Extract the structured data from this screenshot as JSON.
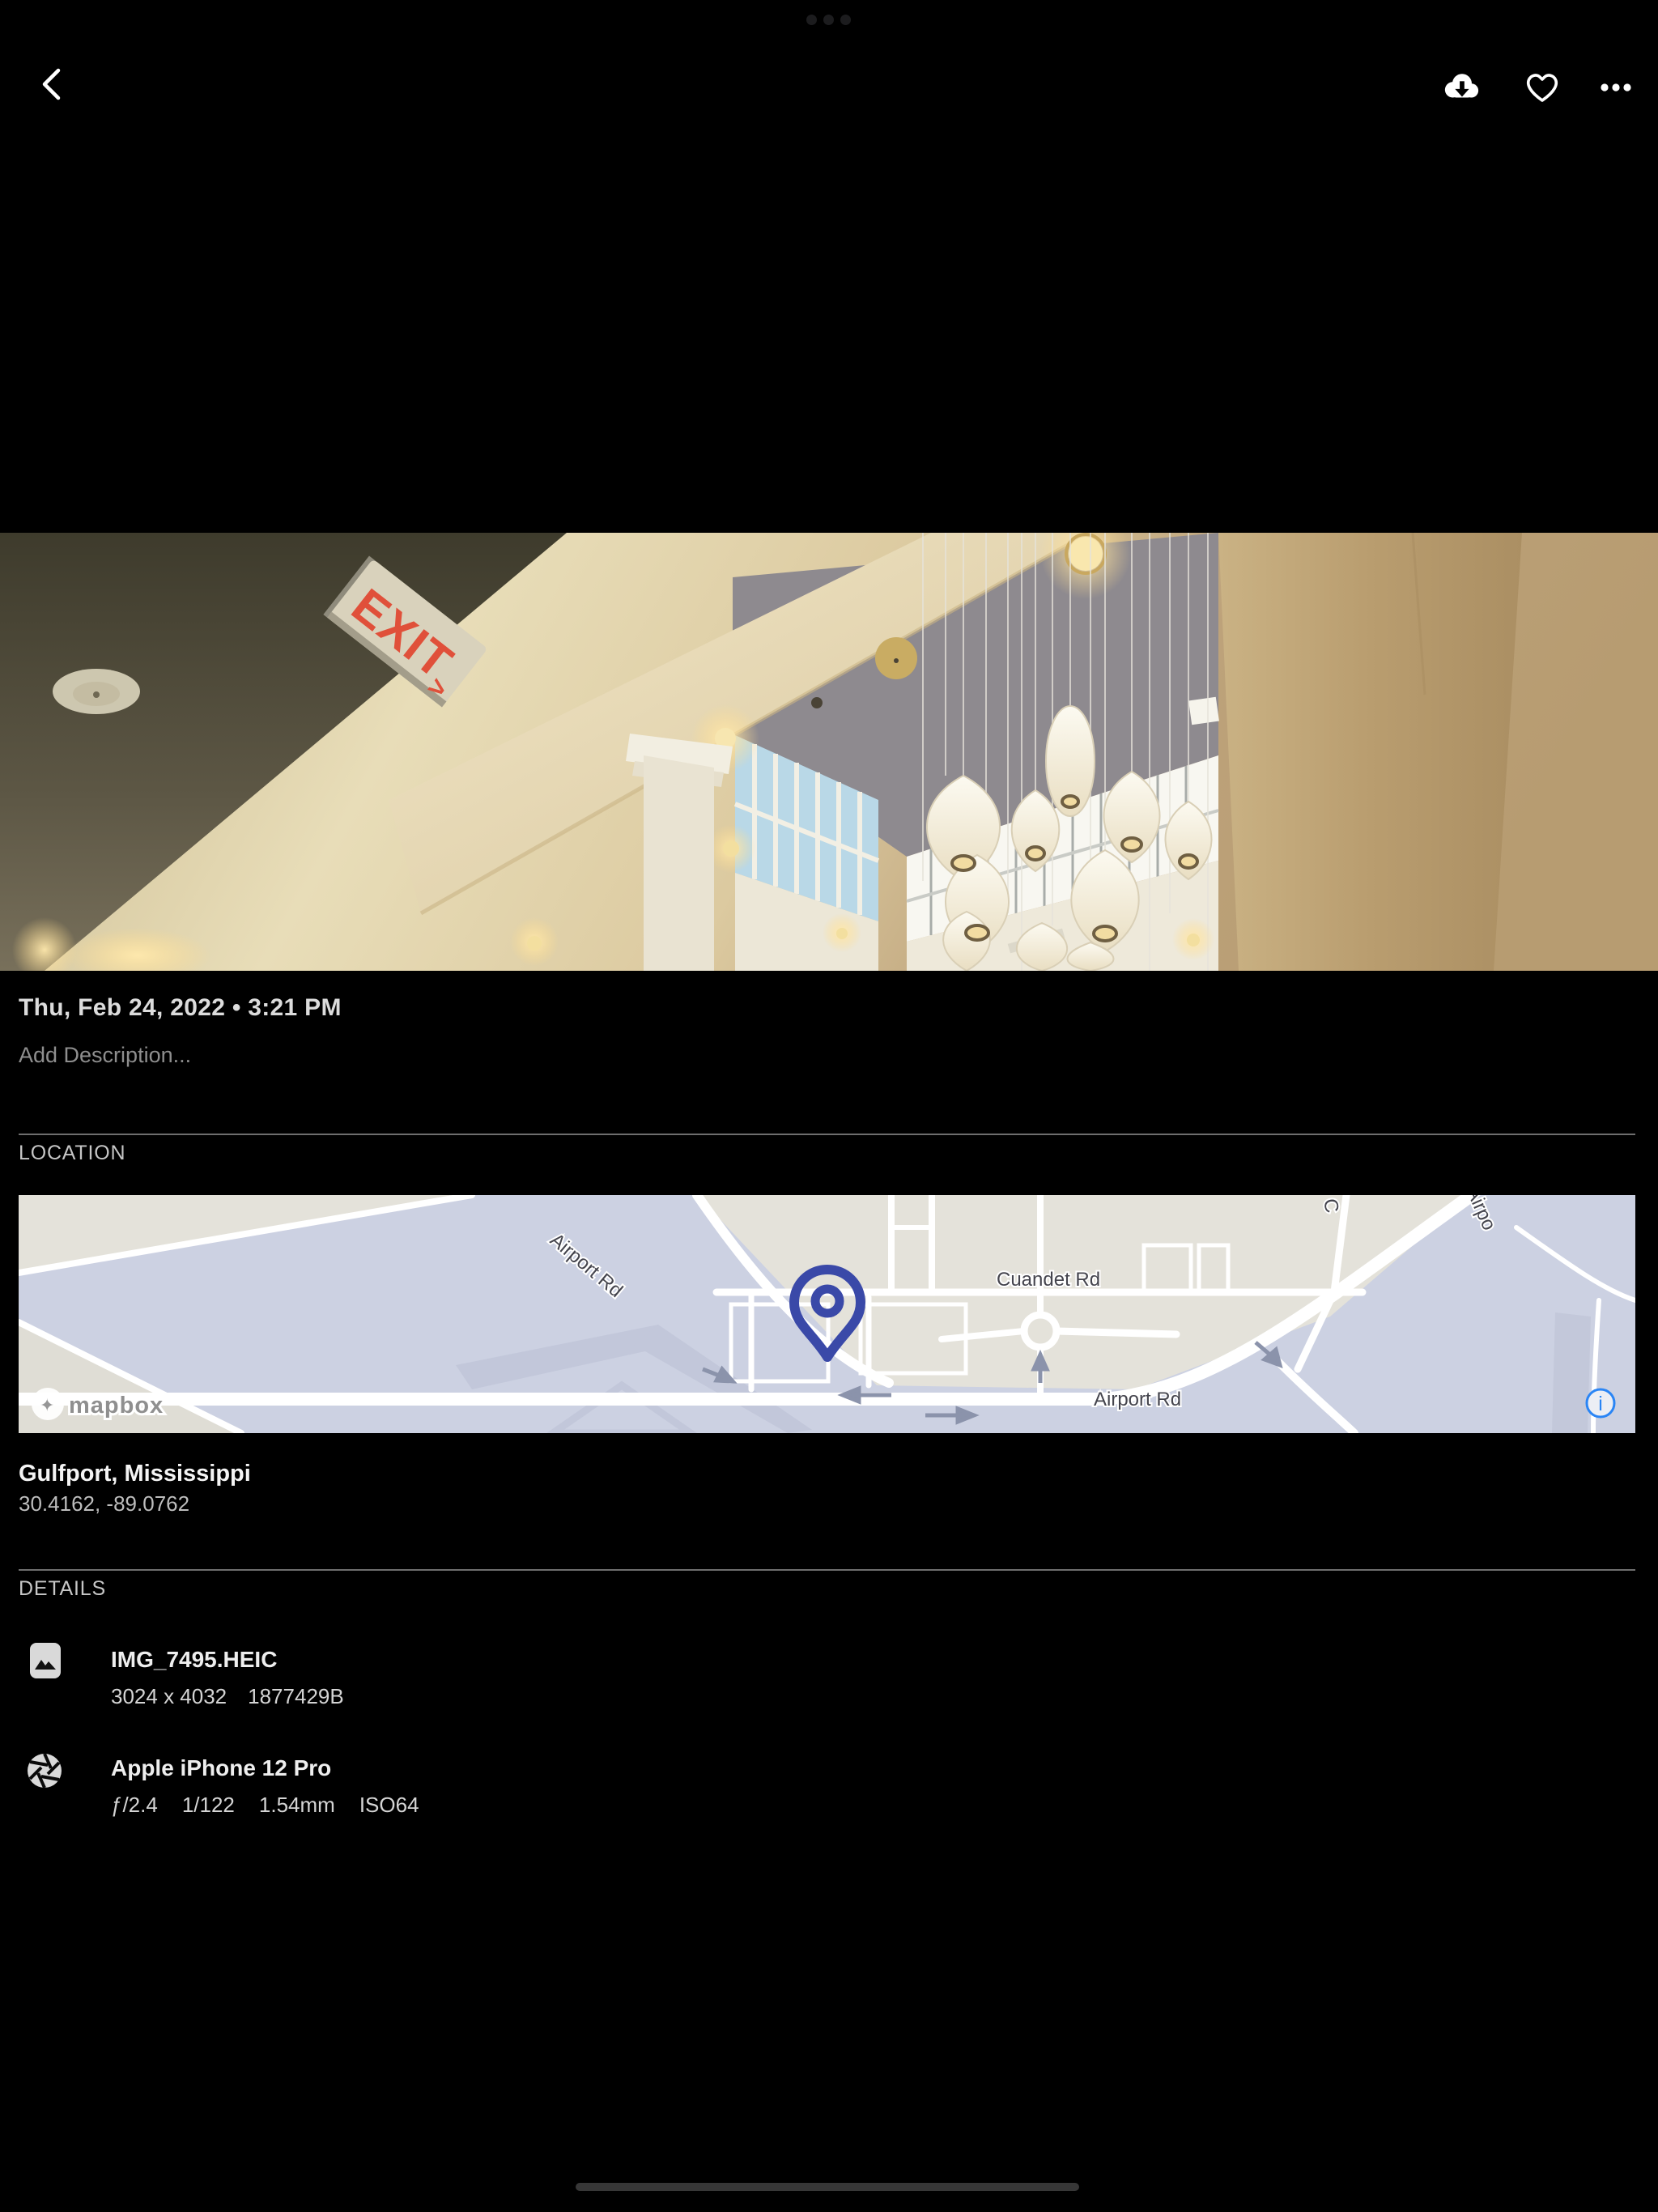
{
  "header": {
    "datetime": "Thu, Feb 24, 2022 • 3:21 PM"
  },
  "description": {
    "placeholder": "Add Description..."
  },
  "photo": {
    "exit_sign": "EXIT",
    "exit_arrow": ">"
  },
  "location": {
    "header": "LOCATION",
    "place": "Gulfport, Mississippi",
    "coordinates": "30.4162, -89.0762",
    "map": {
      "road_labels": {
        "airport_rd_upper": "Airport Rd",
        "cuandet_rd": "Cuandet Rd",
        "airport_rd_lower": "Airport Rd",
        "partial_top": "C",
        "partial_right": "Airpo"
      },
      "attribution": "mapbox",
      "info_label": "i"
    }
  },
  "details": {
    "header": "DETAILS",
    "file": {
      "name": "IMG_7495.HEIC",
      "dimensions": "3024 x 4032",
      "filesize": "1877429B"
    },
    "camera": {
      "model": "Apple iPhone 12 Pro",
      "aperture": "ƒ/2.4",
      "shutter_speed": "1/122",
      "focal_length": "1.54mm",
      "iso": "ISO64"
    }
  },
  "icons": {
    "back": "chevron-left",
    "download": "cloud-download",
    "favorite": "heart-outline",
    "more": "ellipsis",
    "info": "info-circle",
    "file": "image-thumbnail",
    "camera": "aperture"
  },
  "colors": {
    "pin_blue": "#3a49a8",
    "info_blue": "#2a85f5",
    "exit_red": "#e0503a",
    "map_land": "#e4e2da",
    "map_base": "#ccd1e2"
  }
}
